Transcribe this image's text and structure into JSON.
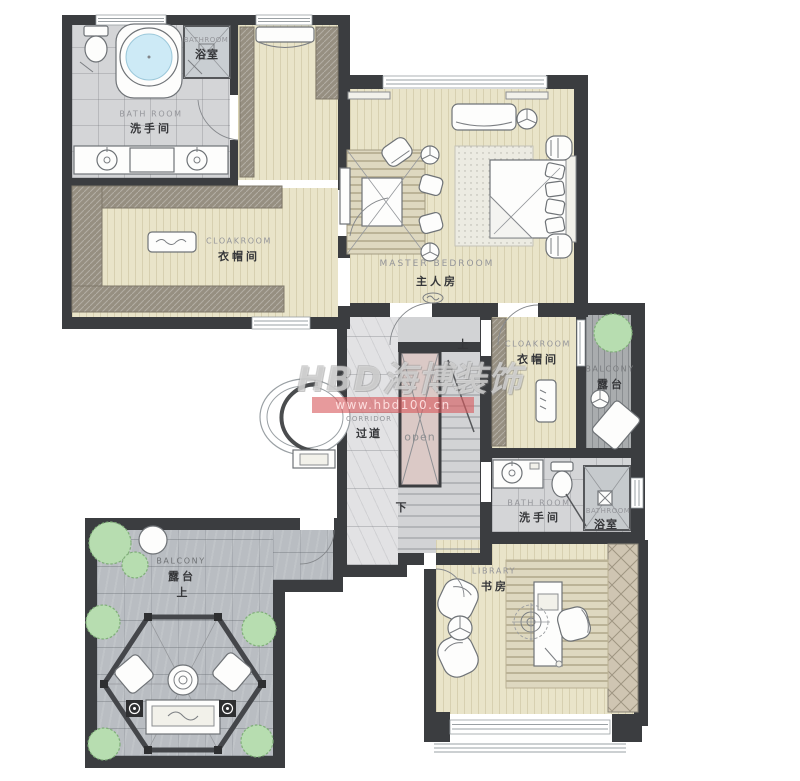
{
  "watermark": {
    "brand": "HBD海博装饰",
    "url": "www.hbd100.cn"
  },
  "stairs": {
    "up": "上",
    "down": "下",
    "void_label": "open"
  },
  "rooms": {
    "bathroom_main": {
      "en": "BATH ROOM",
      "cn": "洗手间"
    },
    "shower_main": {
      "en": "BATHROOM",
      "cn": "浴室"
    },
    "cloakroom_main": {
      "en": "CLOAKROOM",
      "cn": "衣帽间"
    },
    "master_bedroom": {
      "en": "MASTER BEDROOM",
      "cn": "主人房"
    },
    "corridor": {
      "en": "CORRIDOR",
      "cn": "过道"
    },
    "cloakroom_second": {
      "en": "CLOAKROOM",
      "cn": "衣帽间"
    },
    "balcony_right": {
      "en": "BALCONY",
      "cn": "露台"
    },
    "bathroom_second": {
      "en": "BATH ROOM",
      "cn": "洗手间"
    },
    "shower_second": {
      "en": "BATHROOM",
      "cn": "浴室"
    },
    "library": {
      "en": "LIBRARY",
      "cn": "书房"
    },
    "balcony_lower": {
      "en": "BALCONY",
      "cn": "露台",
      "direction": "上"
    }
  },
  "colors": {
    "wall": "#3b3d40",
    "wood": "#e9e4c9",
    "tile": "#d4d5d7",
    "stone": "#b9bdc2",
    "decking": "#a9acae",
    "marble": "#e2e2e4",
    "stair": "#d2d3d5",
    "void_pink": "#dbc9c6",
    "plant": "#b7ddb0",
    "plant_edge": "#7fae78",
    "watermark_red": "#d85c60",
    "water": "#cdeaf6"
  }
}
